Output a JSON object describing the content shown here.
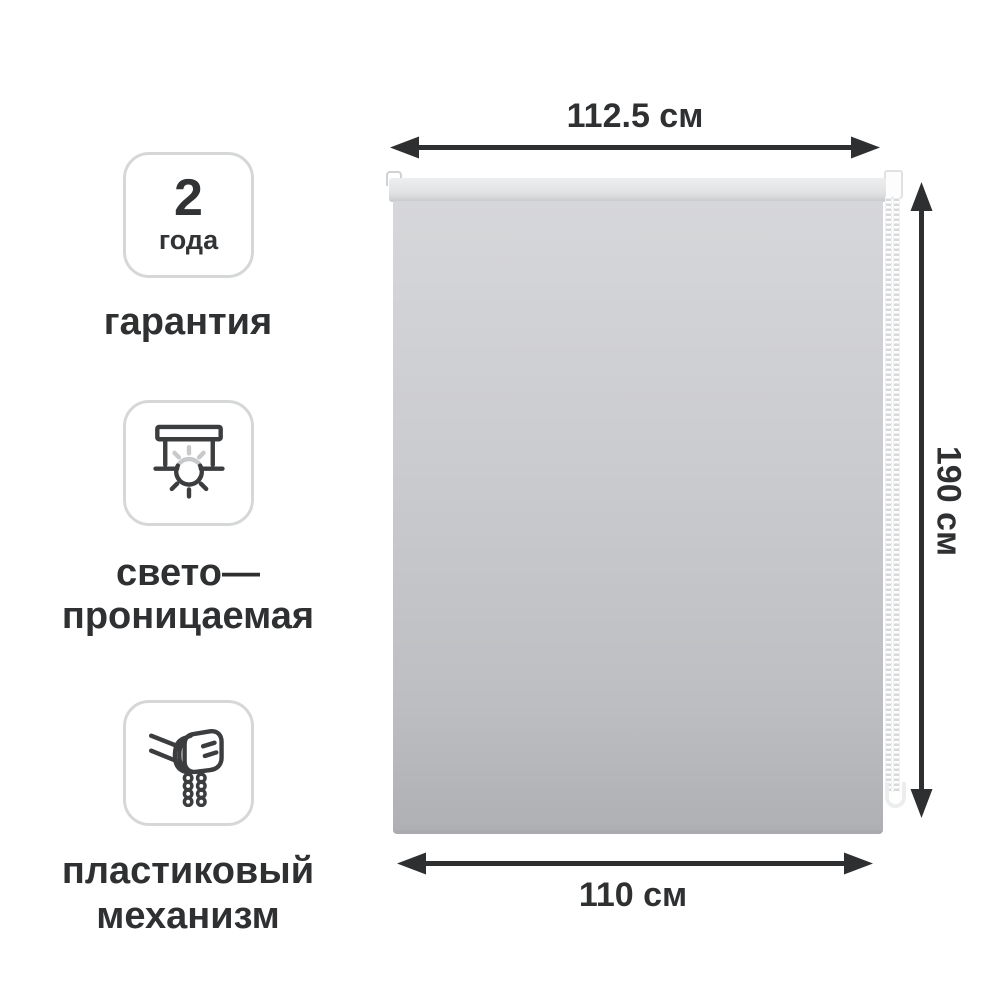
{
  "product": {
    "name": "рулонная штора",
    "fabric_color_top": "#d6d7da",
    "fabric_color_bottom": "#aeb0b3",
    "chain_color": "#ffffff"
  },
  "dimensions": {
    "top": {
      "label": "112.5 см"
    },
    "right": {
      "label": "190 см"
    },
    "bottom": {
      "label": "110 см"
    }
  },
  "features": [
    {
      "icon": "warranty-badge",
      "value": "2",
      "unit": "года",
      "label": "гарантия"
    },
    {
      "icon": "light-transmitting-icon",
      "line1": "свето—",
      "line2": "проницаемая"
    },
    {
      "icon": "plastic-chain-mechanism-icon",
      "line1": "пластиковый",
      "line2": "механизм"
    }
  ],
  "colors": {
    "annotation_text": "#2e3032",
    "arrow": "#2d2f31",
    "badge_border": "#d5d7d9"
  }
}
